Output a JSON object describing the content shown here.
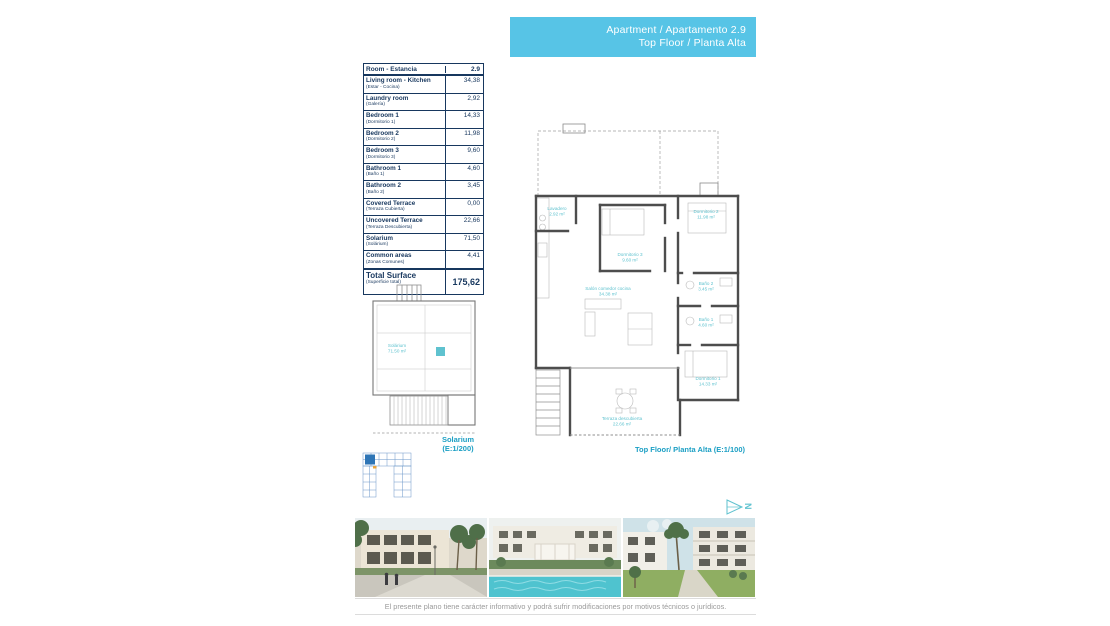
{
  "header": {
    "line1": "Apartment / Apartamento 2.9",
    "line2": "Top Floor / Planta Alta"
  },
  "table": {
    "header": {
      "label": "Room - Estancia",
      "value": "2.9"
    },
    "rows": [
      {
        "name": "Living room - Kitchen",
        "subtitle": "(Estar - Cocina)",
        "value": "34,38"
      },
      {
        "name": "Laundry room",
        "subtitle": "(Galería)",
        "value": "2,92"
      },
      {
        "name": "Bedroom 1",
        "subtitle": "(Dormitorio 1)",
        "value": "14,33"
      },
      {
        "name": "Bedroom 2",
        "subtitle": "(Dormitorio 2)",
        "value": "11,98"
      },
      {
        "name": "Bedroom 3",
        "subtitle": "(Dormitorio 3)",
        "value": "9,60"
      },
      {
        "name": "Bathroom 1",
        "subtitle": "(Baño 1)",
        "value": "4,60"
      },
      {
        "name": "Bathroom 2",
        "subtitle": "(Baño 2)",
        "value": "3,45"
      },
      {
        "name": "Covered Terrace",
        "subtitle": "(Terraza Cubierta)",
        "value": "0,00"
      },
      {
        "name": "Uncovered Terrace",
        "subtitle": "(Terraza Descubierta)",
        "value": "22,66"
      },
      {
        "name": "Solarium",
        "subtitle": "(Solárium)",
        "value": "71,50"
      },
      {
        "name": "Common areas",
        "subtitle": "(Zonas Comunes)",
        "value": "4,41"
      }
    ],
    "total": {
      "name": "Total Surface",
      "subtitle": "(Superficie total)",
      "value": "175,62"
    }
  },
  "plans": {
    "main": {
      "caption": "Top Floor/ Planta Alta (E:1/100)",
      "rooms": [
        {
          "label": "Lavadero",
          "area": "2.92 m²"
        },
        {
          "label": "Dormitorio 2",
          "area": "11.98 m²"
        },
        {
          "label": "Dormitorio 3",
          "area": "9.60 m²"
        },
        {
          "label": "Salón comedor cocina",
          "area": "34.38 m²"
        },
        {
          "label": "Baño 2",
          "area": "3.45 m²"
        },
        {
          "label": "Baño 1",
          "area": "4.60 m²"
        },
        {
          "label": "Dormitorio 1",
          "area": "14.33 m²"
        },
        {
          "label": "Terraza descubierta",
          "area": "22.66 m²"
        }
      ]
    },
    "solarium": {
      "caption_line1": "Solarium",
      "caption_line2": "(E:1/200)",
      "rooms": [
        {
          "label": "Solárium",
          "area": "71.50 m²"
        }
      ]
    }
  },
  "compass": {
    "letter": "N"
  },
  "footer": {
    "disclaimer": "El presente plano tiene carácter informativo y podrá sufrir modificaciones por motivos técnicos o jurídicos."
  },
  "photos": {
    "names": [
      "street-render-photo",
      "pool-courtyard-render-photo",
      "garden-render-photo"
    ]
  },
  "colors": {
    "banner": "#57c4e6",
    "caption": "#1b9fc4",
    "plan-label": "#5fc2cf",
    "table-ink": "#17375e",
    "keyplan": "#6b96c8"
  }
}
